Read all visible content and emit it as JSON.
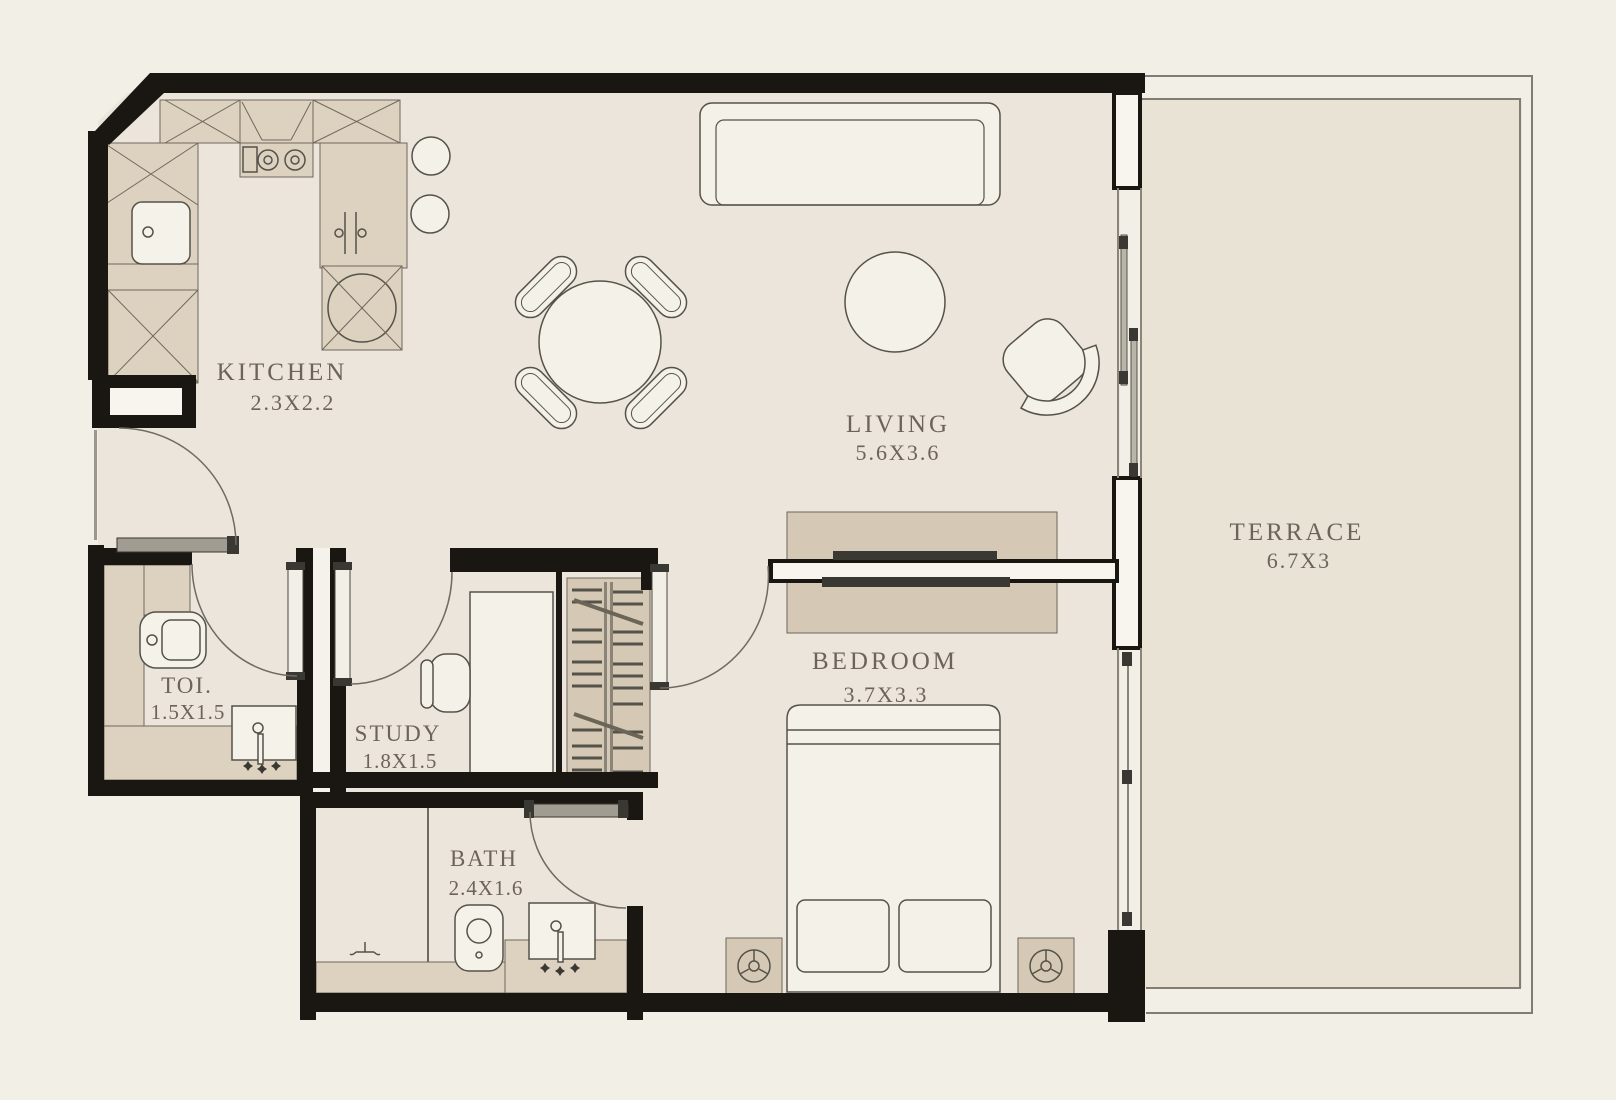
{
  "title": "Apartment floor plan",
  "rooms": {
    "kitchen": {
      "label": "KITCHEN",
      "dims": "2.3X2.2"
    },
    "living": {
      "label": "LIVING",
      "dims": "5.6X3.6"
    },
    "terrace": {
      "label": "TERRACE",
      "dims": "6.7X3"
    },
    "toilet": {
      "label": "TOI.",
      "dims": "1.5X1.5"
    },
    "study": {
      "label": "STUDY",
      "dims": "1.8X1.5"
    },
    "bath": {
      "label": "BATH",
      "dims": "2.4X1.6"
    },
    "bedroom": {
      "label": "BEDROOM",
      "dims": "3.7X3.3"
    }
  },
  "palette": {
    "walls": "#1a1713",
    "floor": "#ebe5dc",
    "terrace_floor": "#e9e3d6",
    "background": "#f2efe7",
    "cabinetry": "#ddd2c0",
    "wood": "#d5c9b6",
    "fixture_white": "#f5f2e9",
    "label_text": "#6c635a"
  }
}
